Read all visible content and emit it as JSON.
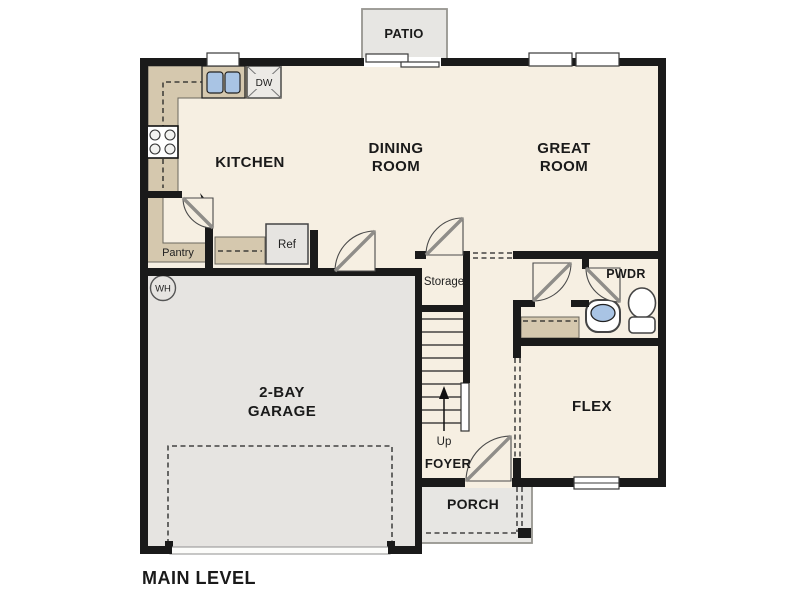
{
  "floorplan": {
    "title": "MAIN LEVEL",
    "rooms": {
      "patio": "PATIO",
      "kitchen": "KITCHEN",
      "dining_line1": "DINING",
      "dining_line2": "ROOM",
      "great_line1": "GREAT",
      "great_line2": "ROOM",
      "garage_line1": "2-BAY",
      "garage_line2": "GARAGE",
      "flex": "FLEX",
      "foyer": "FOYER",
      "porch": "PORCH",
      "pwdr": "PWDR",
      "storage": "Storage",
      "pantry": "Pantry"
    },
    "fixtures": {
      "refrigerator": "Ref",
      "dishwasher": "DW",
      "water_heater": "WH",
      "stairs_direction": "Up"
    },
    "colors": {
      "wall": "#1a1a1a",
      "floor": "#f6efe2",
      "counter_tan": "#d5c8ae",
      "garage_gray": "#e6e4e1",
      "exterior_gray": "#e7e6e3",
      "sink_blue": "#a9c4e4"
    }
  }
}
